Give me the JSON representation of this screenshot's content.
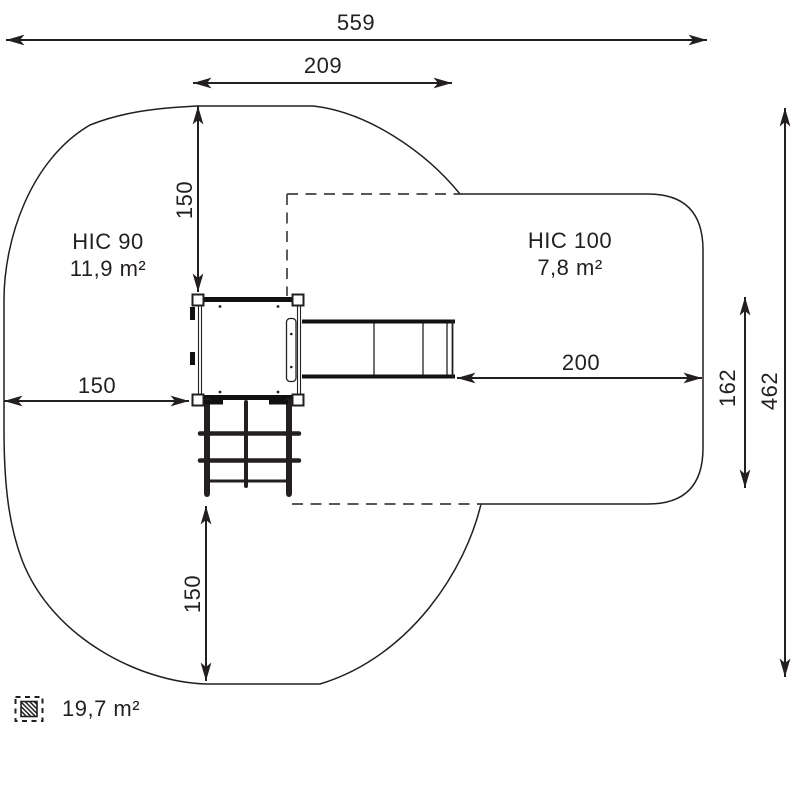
{
  "dimensions": {
    "total_width": "559",
    "upper_width": "209",
    "top_offset": "150",
    "left_offset": "150",
    "bottom_offset": "150",
    "right_offset": "200",
    "right_edge_height": "162",
    "total_height": "462"
  },
  "zones": {
    "hic90": {
      "name": "HIC 90",
      "area": "11,9 m²"
    },
    "hic100": {
      "name": "HIC 100",
      "area": "7,8 m²"
    }
  },
  "legend": {
    "total_area": "19,7 m²"
  },
  "colors": {
    "line": "#231f20",
    "dashed_line": "#414042",
    "background": "#ffffff"
  }
}
